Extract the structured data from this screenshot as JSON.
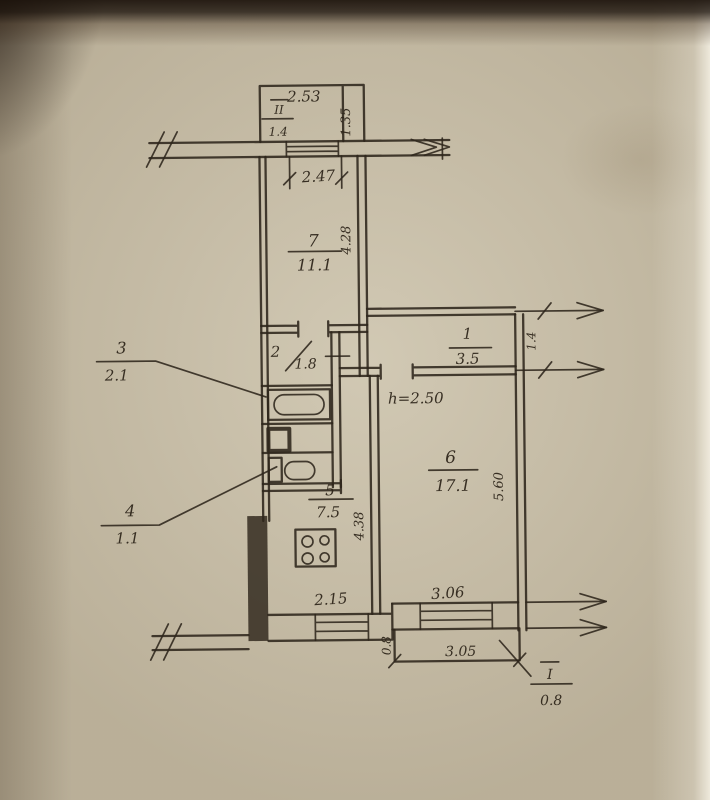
{
  "plan": {
    "ceiling_note": "h=2.50",
    "rooms": {
      "r1": {
        "number": "1",
        "area": "3.5"
      },
      "r2": {
        "number": "2",
        "area": "1.8"
      },
      "r3": {
        "number": "3",
        "area": "2.1"
      },
      "r4": {
        "number": "4",
        "area": "1.1"
      },
      "r5": {
        "number": "5",
        "area": "7.5"
      },
      "r6": {
        "number": "6",
        "area": "17.1"
      },
      "r7": {
        "number": "7",
        "area": "11.1"
      }
    },
    "balconies": {
      "top": {
        "number": "II",
        "area": "1.4"
      },
      "bottom": {
        "number": "I",
        "area": "0.8"
      }
    },
    "dimensions": {
      "balcony_top_width": "2.53",
      "balcony_top_depth": "1.35",
      "top_window_width": "2.47",
      "room7_depth": "4.28",
      "hall_depth": "1.4",
      "kitchen_depth": "4.38",
      "room6_depth": "5.60",
      "kitchen_window_width": "2.15",
      "room6_window_width": "3.06",
      "balcony_bottom_width": "3.05",
      "balcony_bottom_depth": "0.8"
    }
  }
}
